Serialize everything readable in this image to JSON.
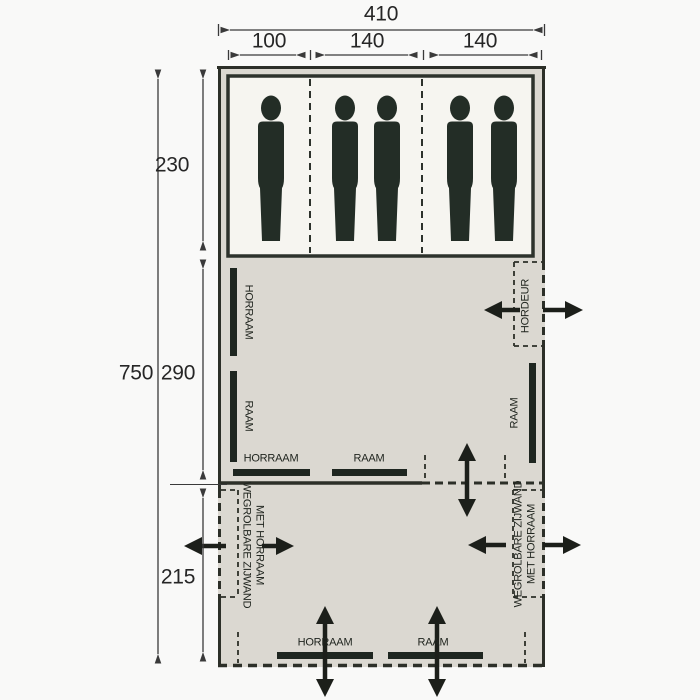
{
  "dimensions": {
    "width_total": "410",
    "width_sections": [
      "100",
      "140",
      "140"
    ],
    "depth_total": "750",
    "depth_sections": [
      "230",
      "290",
      "215"
    ]
  },
  "labels": {
    "left_wall": {
      "window_mesh": "HORRAAM",
      "window": "RAAM"
    },
    "right_wall": {
      "door": "HORDEUR",
      "window": "RAAM"
    },
    "inner_divider": {
      "window_mesh": "HORRAAM",
      "window": "RAAM"
    },
    "front_wall": {
      "window_mesh": "HORRAAM",
      "window": "RAAM"
    },
    "rollaway_left": {
      "line1": "WEGROLBARE ZIJWAND",
      "line2": "MET HORRAAM"
    },
    "rollaway_right": {
      "line1": "WEGROLBARE ZIJWAND",
      "line2": "MET HORRAAM"
    }
  },
  "figures": {
    "count": 5,
    "icon": "person-silhouette"
  },
  "colors": {
    "background": "#f9f9f8",
    "tent_fill": "#dbd8d1",
    "cabin_fill": "#f6f5f0",
    "wall": "#2c2f28",
    "figure": "#232d26",
    "annotation": "#2e2e2e"
  }
}
